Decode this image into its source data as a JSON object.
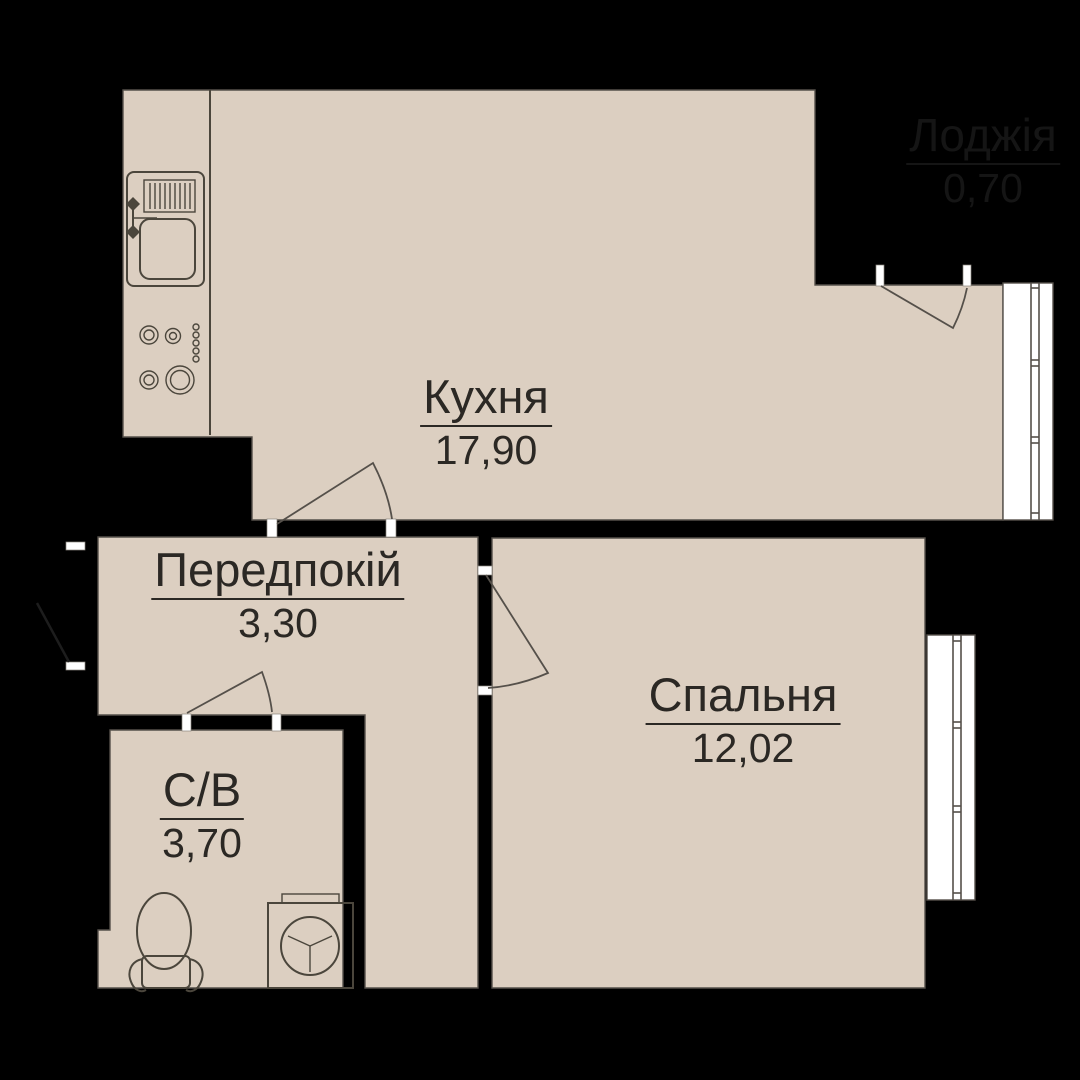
{
  "plan": {
    "type": "apartment-floor-plan",
    "rooms": [
      {
        "id": "kitchen",
        "name": "Кухня",
        "area": "17,90"
      },
      {
        "id": "hallway",
        "name": "Передпокій",
        "area": "3,30"
      },
      {
        "id": "bedroom",
        "name": "Спальня",
        "area": "12,02"
      },
      {
        "id": "bathroom",
        "name": "С/В",
        "area": "3,70"
      },
      {
        "id": "loggia",
        "name": "Лоджія",
        "area": "0,70"
      }
    ],
    "colors": {
      "background": "#000000",
      "floor": "#dccfc1",
      "outline": "#4b463c",
      "edge": "#55504a",
      "window_fill": "#ffffff",
      "window_line": "#55504a",
      "jamb": "#ffffff",
      "label_text": "#2b2824",
      "loggia_text": "#151515"
    }
  }
}
